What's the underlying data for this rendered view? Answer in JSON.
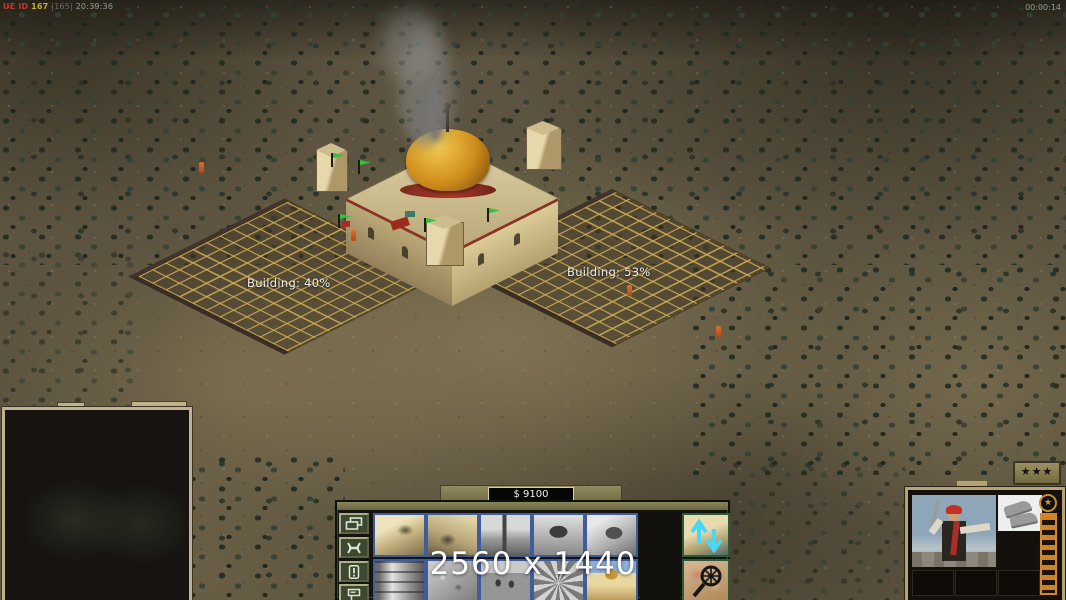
{
  "hud": {
    "debug_ue_label": "UE ID",
    "debug_ue_value": "167",
    "debug_alt_value": "|165|",
    "debug_clock": "20:39:36",
    "match_timer": "00:00:14",
    "resolution_overlay": "2560 x 1440"
  },
  "world": {
    "building_labels": [
      {
        "text": "Building: 40%"
      },
      {
        "text": "Building: 53%"
      }
    ]
  },
  "economy": {
    "funds": "$ 9100"
  },
  "command_bar": {
    "tab_buttons": [
      {
        "icon": "windows-icon"
      },
      {
        "icon": "wrench-icon"
      },
      {
        "icon": "exclamation-icon"
      },
      {
        "icon": "signpost-icon"
      }
    ],
    "build_slots": [
      {
        "icon": "tan-compound-thumbnail",
        "style": "color"
      },
      {
        "icon": "tan-factory-thumbnail",
        "style": "color"
      },
      {
        "icon": "gray-derrick-thumbnail",
        "style": "gray"
      },
      {
        "icon": "gray-bunker-thumbnail",
        "style": "gray"
      },
      {
        "icon": "gray-depot-thumbnail",
        "style": "gray"
      },
      {
        "icon": "gray-barrel-thumbnail",
        "style": "gray"
      },
      {
        "icon": "gray-ruins-thumbnail",
        "style": "gray"
      },
      {
        "icon": "gray-town-thumbnail",
        "style": "gray"
      },
      {
        "icon": "gray-wheel-thumbnail",
        "style": "gray"
      },
      {
        "icon": "mosque-thumbnail",
        "style": "color"
      }
    ],
    "special_slots": [
      {
        "icon": "upgrade-arrows-icon"
      },
      {
        "icon": "map-magnifier-icon"
      }
    ]
  },
  "unit_panel": {
    "rank_stars": "★★★",
    "veterancy_star": "★"
  },
  "colors": {
    "panel_olive": "#77714a",
    "cell_border_blue": "#3f5c9c",
    "xp_orange": "#c87c20",
    "flag_green": "#2fc23c",
    "money_text": "#f0f0f0"
  }
}
